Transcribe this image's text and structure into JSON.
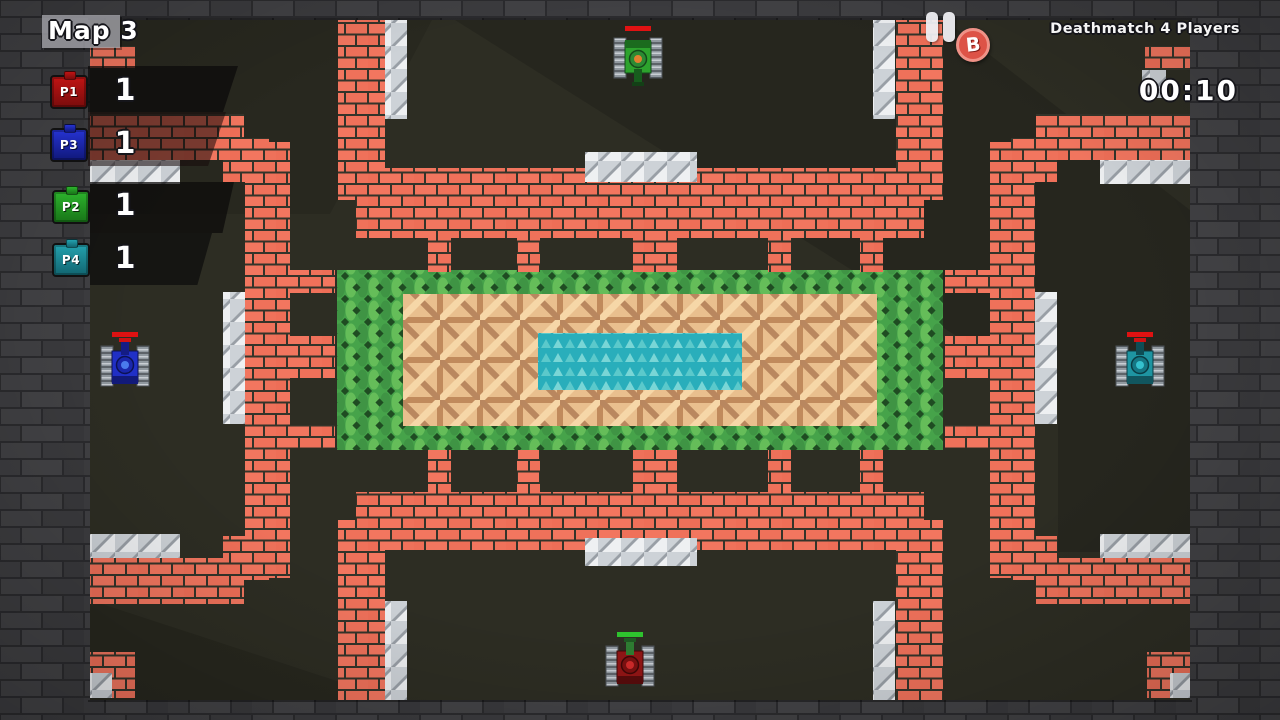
{
  "hud": {
    "map_title": "Map 3",
    "mode_label": "Deathmatch 4 Players",
    "timer": "00:10",
    "bomb_badge_letter": "B",
    "players": [
      {
        "id": "P1",
        "score": "1",
        "color": "#c01414",
        "color_dark": "#7a0c0c"
      },
      {
        "id": "P3",
        "score": "1",
        "color": "#2633d2",
        "color_dark": "#10187a"
      },
      {
        "id": "P2",
        "score": "1",
        "color": "#2db32d",
        "color_dark": "#187518"
      },
      {
        "id": "P4",
        "score": "1",
        "color": "#23a1ae",
        "color_dark": "#126570"
      }
    ]
  },
  "game": {
    "tanks": [
      {
        "player": "P2",
        "color_name": "green",
        "x": 613,
        "y": 32,
        "facing": "down",
        "health_color": "#e01212"
      },
      {
        "player": "P3",
        "color_name": "blue",
        "x": 100,
        "y": 338,
        "facing": "up",
        "health_color": "#e01212"
      },
      {
        "player": "P4",
        "color_name": "teal",
        "x": 1115,
        "y": 338,
        "facing": "up",
        "health_color": "#e01212"
      },
      {
        "player": "P1",
        "color_name": "red",
        "x": 605,
        "y": 638,
        "facing": "up",
        "health_color": "#2ec22e"
      }
    ],
    "terrain": {
      "field": "#2d2d23",
      "frame_brick": "#3f3f42",
      "brick": "#f2765f",
      "metal": "#d9dce0",
      "bush": "#4aa84e",
      "wood": "#e9bf8e",
      "water": "#29aebb"
    }
  }
}
